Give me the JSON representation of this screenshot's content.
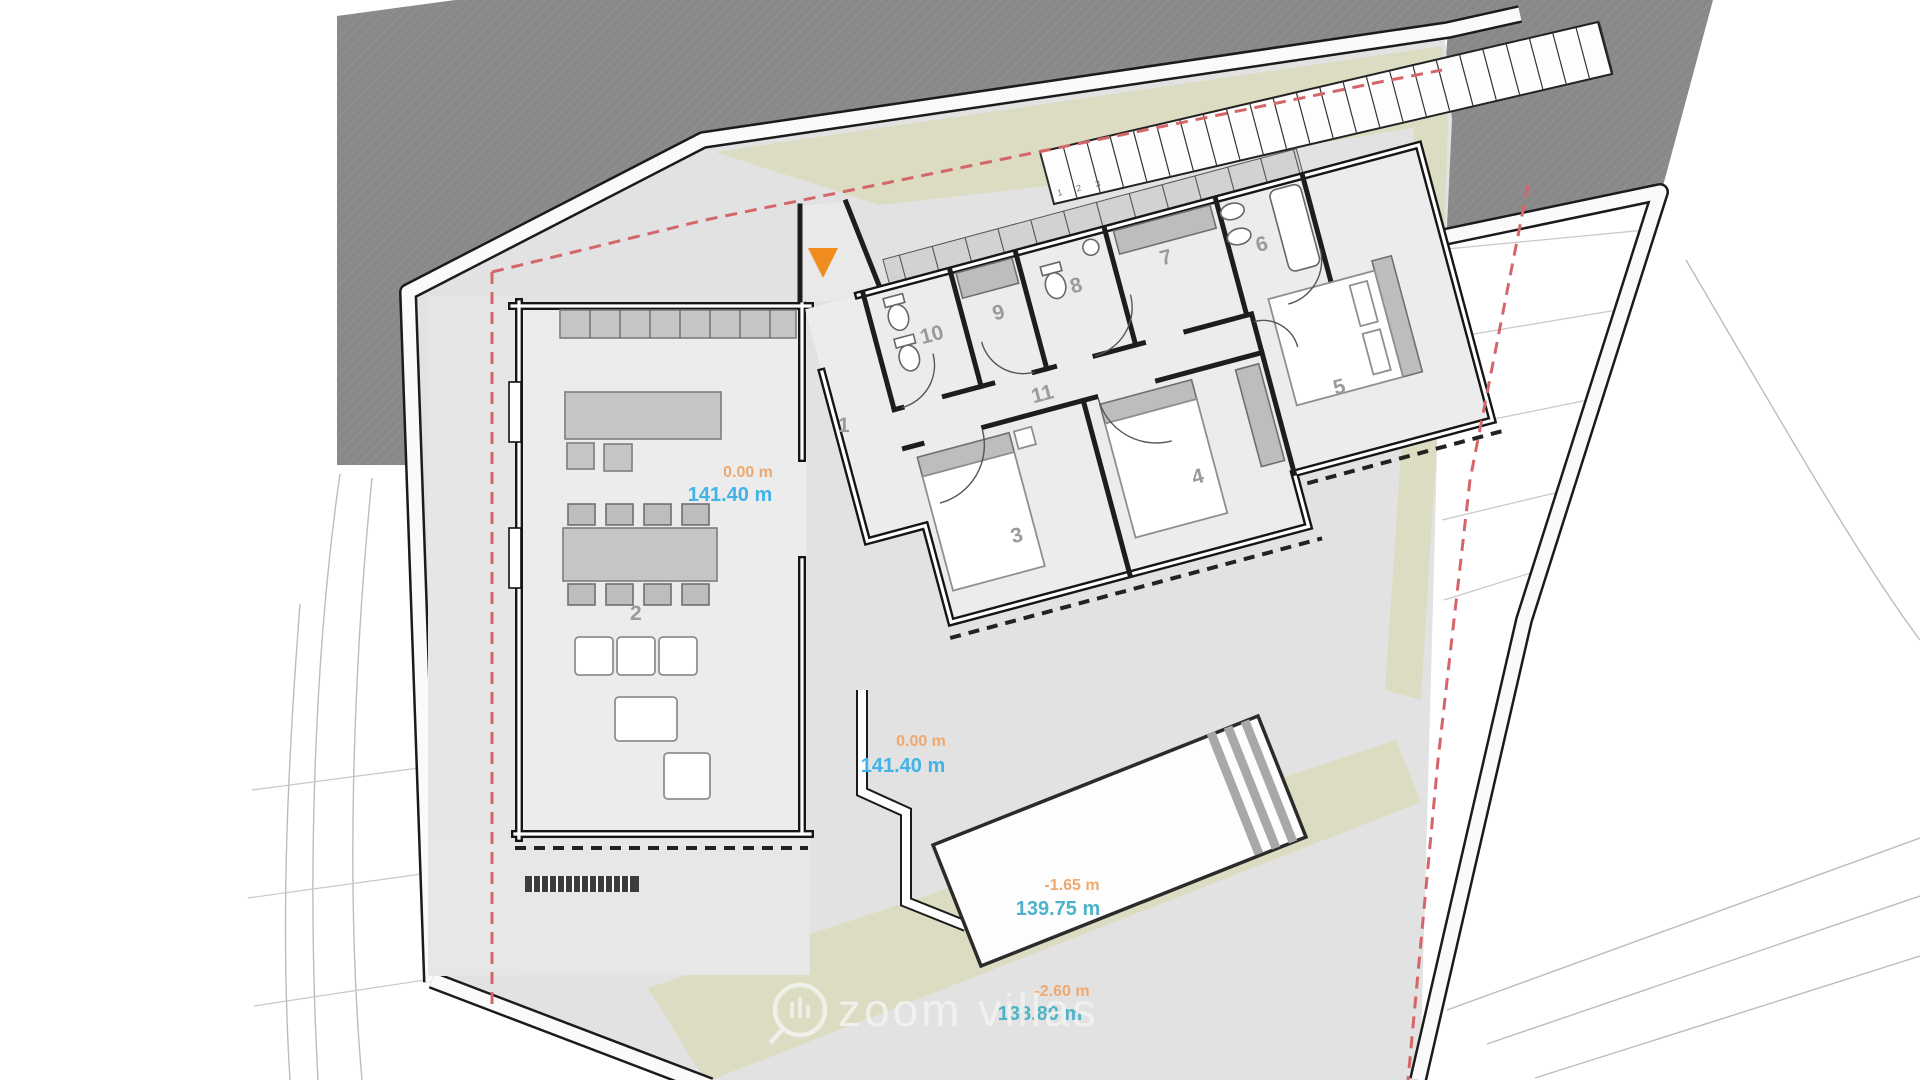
{
  "plan": {
    "rooms": [
      "1",
      "2",
      "3",
      "4",
      "5",
      "6",
      "7",
      "8",
      "9",
      "10",
      "11"
    ],
    "elevations": [
      {
        "rel": "0.00 m",
        "abs": "141.40 m"
      },
      {
        "rel": "0.00 m",
        "abs": "141.40 m"
      },
      {
        "rel": "-1.65 m",
        "abs": "139.75 m"
      },
      {
        "rel": "-2.60 m",
        "abs": "138.80 m"
      }
    ],
    "stair_step_numbers": "1 2 3",
    "watermark": "zoom villas",
    "colors": {
      "road_area": "#8a8a8a",
      "terrain": "#e2e2e2",
      "landscape_strip": "#dcdcc2",
      "setback_line": "#d4666a",
      "elevation_relative_text": "#efa96f",
      "elevation_absolute_text": "#41b3e6",
      "elevation_absolute_teal_text": "#4db3c8",
      "entrance_marker": "#f08c1e"
    }
  }
}
